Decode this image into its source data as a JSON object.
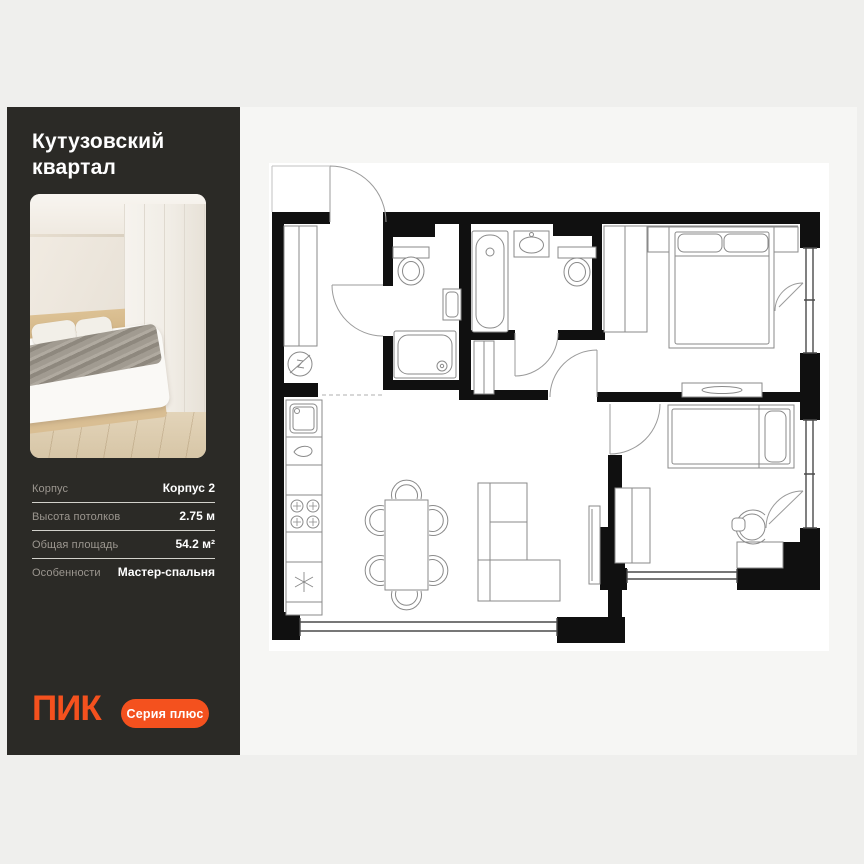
{
  "page": {
    "background": "#EFEFED"
  },
  "card": {
    "background": "#F6F6F4"
  },
  "sidebar": {
    "background": "#2B2A26",
    "title": "Кутузовский квартал",
    "photo": {
      "name": "bedroom-render-photo"
    },
    "details": {
      "rows": [
        {
          "label": "Корпус",
          "value": "Корпус 2"
        },
        {
          "label": "Высота потолков",
          "value": "2.75 м"
        },
        {
          "label": "Общая площадь",
          "value": "54.2 м²"
        },
        {
          "label": "Особенности",
          "value": "Мастер-спальня"
        }
      ]
    },
    "brand": {
      "logo_text": "ПИК",
      "badge_text": "Серия плюс",
      "accent_color": "#F4511E"
    }
  },
  "floorplan": {
    "kind": "apartment-floor-plan",
    "wall_color": "#101010",
    "fixture_line_color": "#8A8A8A",
    "elements": [
      "entrance-door",
      "hallway-closet",
      "electrical-panel",
      "wc-toilet",
      "wc-sink",
      "shower-tray",
      "bathtub",
      "bathroom-sink",
      "bathroom-toilet",
      "kitchen-sink",
      "kitchen-hob",
      "fridge",
      "dining-table-6-chairs",
      "corner-sofa",
      "tv-panel",
      "master-bed",
      "nightstands",
      "wardrobes",
      "dresser",
      "single-bed",
      "desk",
      "desk-chair",
      "windows",
      "balcony-doors"
    ]
  }
}
